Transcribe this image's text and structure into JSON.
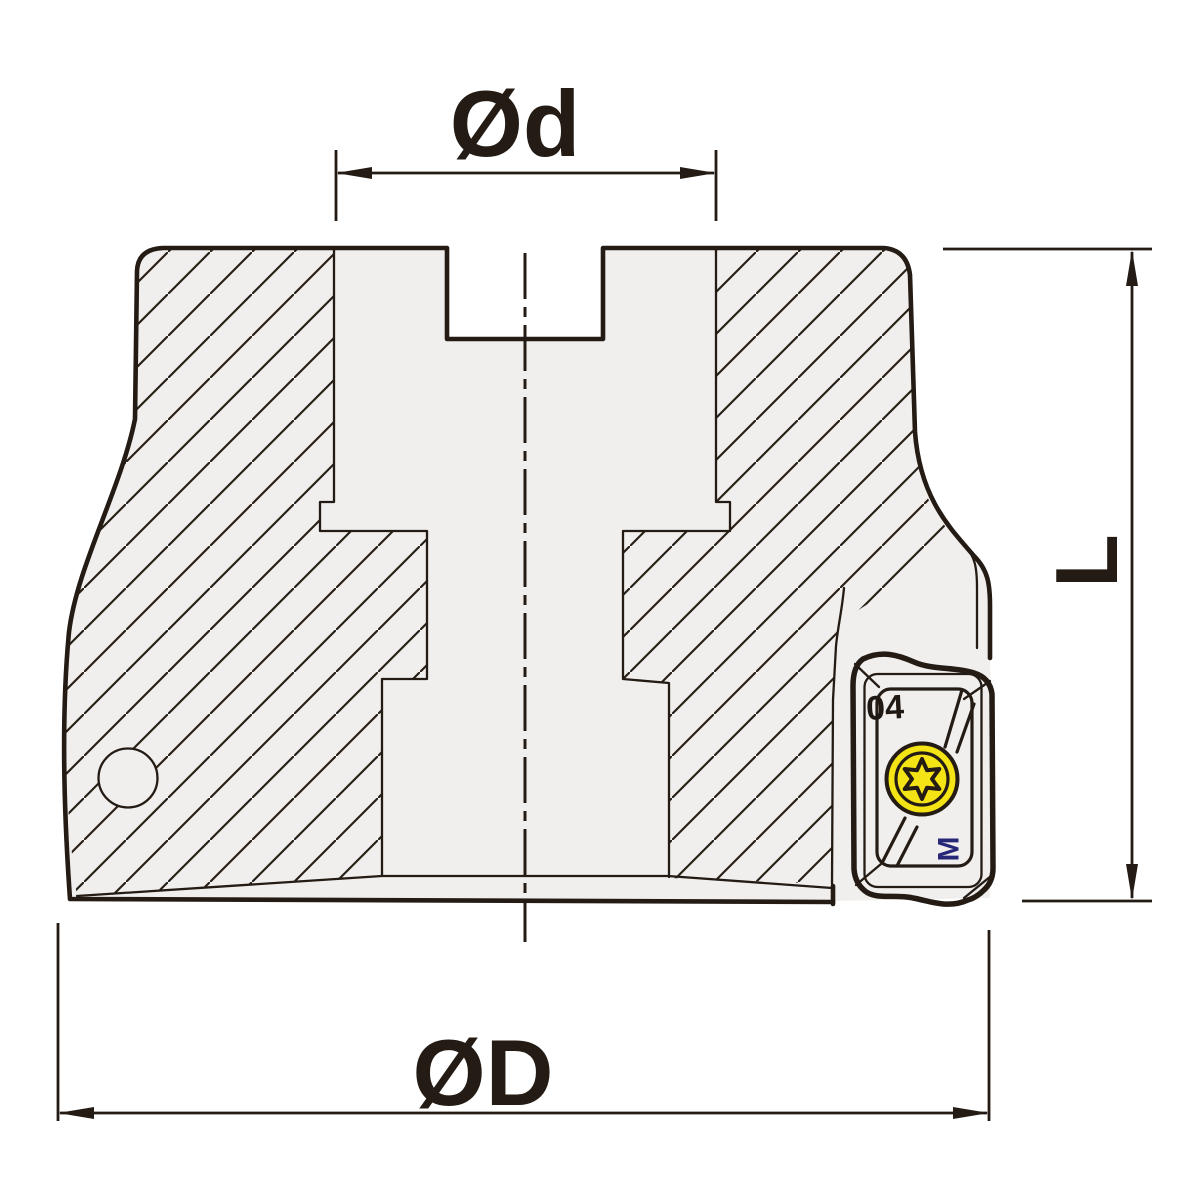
{
  "drawing": {
    "type": "technical-section-drawing",
    "subject": "face-milling-cutter-with-indexable-insert"
  },
  "dimensions": {
    "bore_diameter_label": "Ød",
    "outer_diameter_label": "ØD",
    "height_label": "L"
  },
  "insert": {
    "marking_top": "04",
    "marking_bottom": "M"
  },
  "colors": {
    "background": "#ffffff",
    "body_fill": "#f1efed",
    "line": "#231b14",
    "insert_fill": "#f4e416",
    "insert_marking": "#272777"
  }
}
